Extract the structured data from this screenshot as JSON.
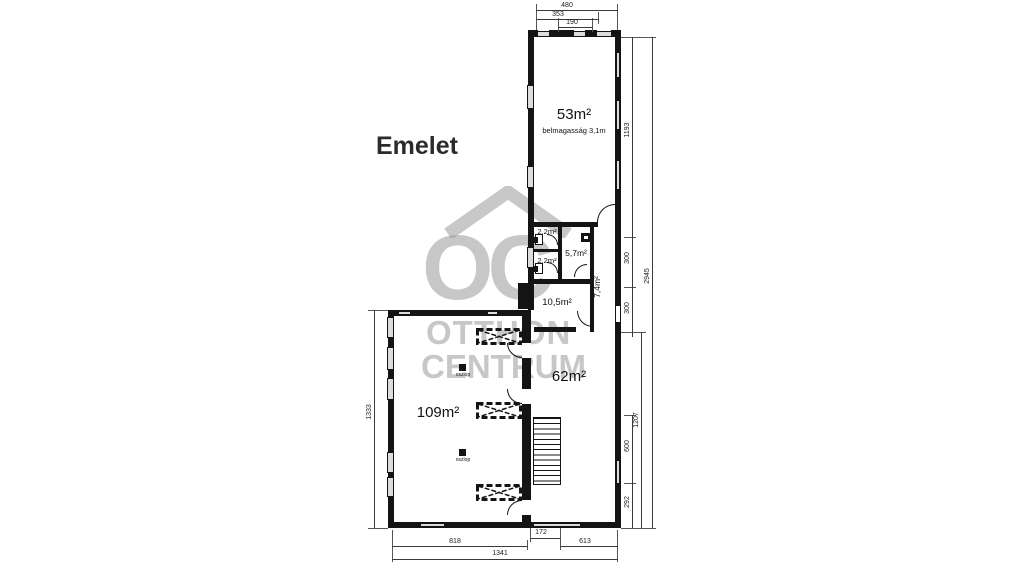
{
  "title": "Emelet",
  "watermark": {
    "oc": "OC",
    "line1": "OTTHON",
    "line2": "CENTRUM",
    "color": "#9a9a9a"
  },
  "rooms": {
    "r53": {
      "label": "53m²",
      "note": "belmagasság 3,1m"
    },
    "r22a": {
      "label": "2,2m²"
    },
    "r22b": {
      "label": "2,2m²"
    },
    "r57": {
      "label": "5,7m²"
    },
    "r74": {
      "label": "7,4m²"
    },
    "r105": {
      "label": "10,5m²"
    },
    "r62": {
      "label": "62m²"
    },
    "r109": {
      "label": "109m²"
    }
  },
  "annotations": {
    "column_label": "oszlop"
  },
  "dims": {
    "top_outer": "480",
    "top_mid": "353",
    "top_inner": "190",
    "right_a": "1193",
    "right_b": "300",
    "right_c": "300",
    "right_d": "600",
    "right_e": "292",
    "right_mid": "1207",
    "right_outer": "2945",
    "left": "1333",
    "bottom_a": "818",
    "bottom_b": "172",
    "bottom_c": "613",
    "bottom_total": "1341"
  }
}
